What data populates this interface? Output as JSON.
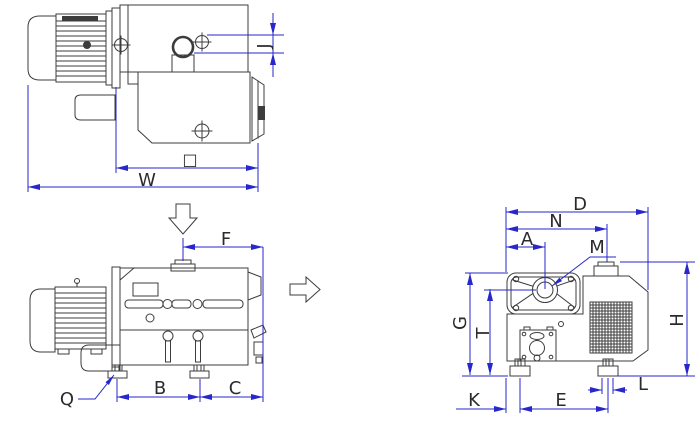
{
  "colors": {
    "background": "#ffffff",
    "geometry_line": "#3c3c3c",
    "dimension_line": "#2727cc",
    "label_text": "#2b2b2b"
  },
  "labels": {
    "box": "□",
    "W": "W",
    "J": "J",
    "F": "F",
    "B": "B",
    "C": "C",
    "Q": "Q",
    "D": "D",
    "N": "N",
    "A": "A",
    "M": "M",
    "G": "G",
    "T": "T",
    "H": "H",
    "K": "K",
    "E": "E",
    "L": "L"
  },
  "icons": {
    "inlet_flow": "hollow-arrow-down",
    "exhaust_flow": "hollow-arrow-right"
  }
}
